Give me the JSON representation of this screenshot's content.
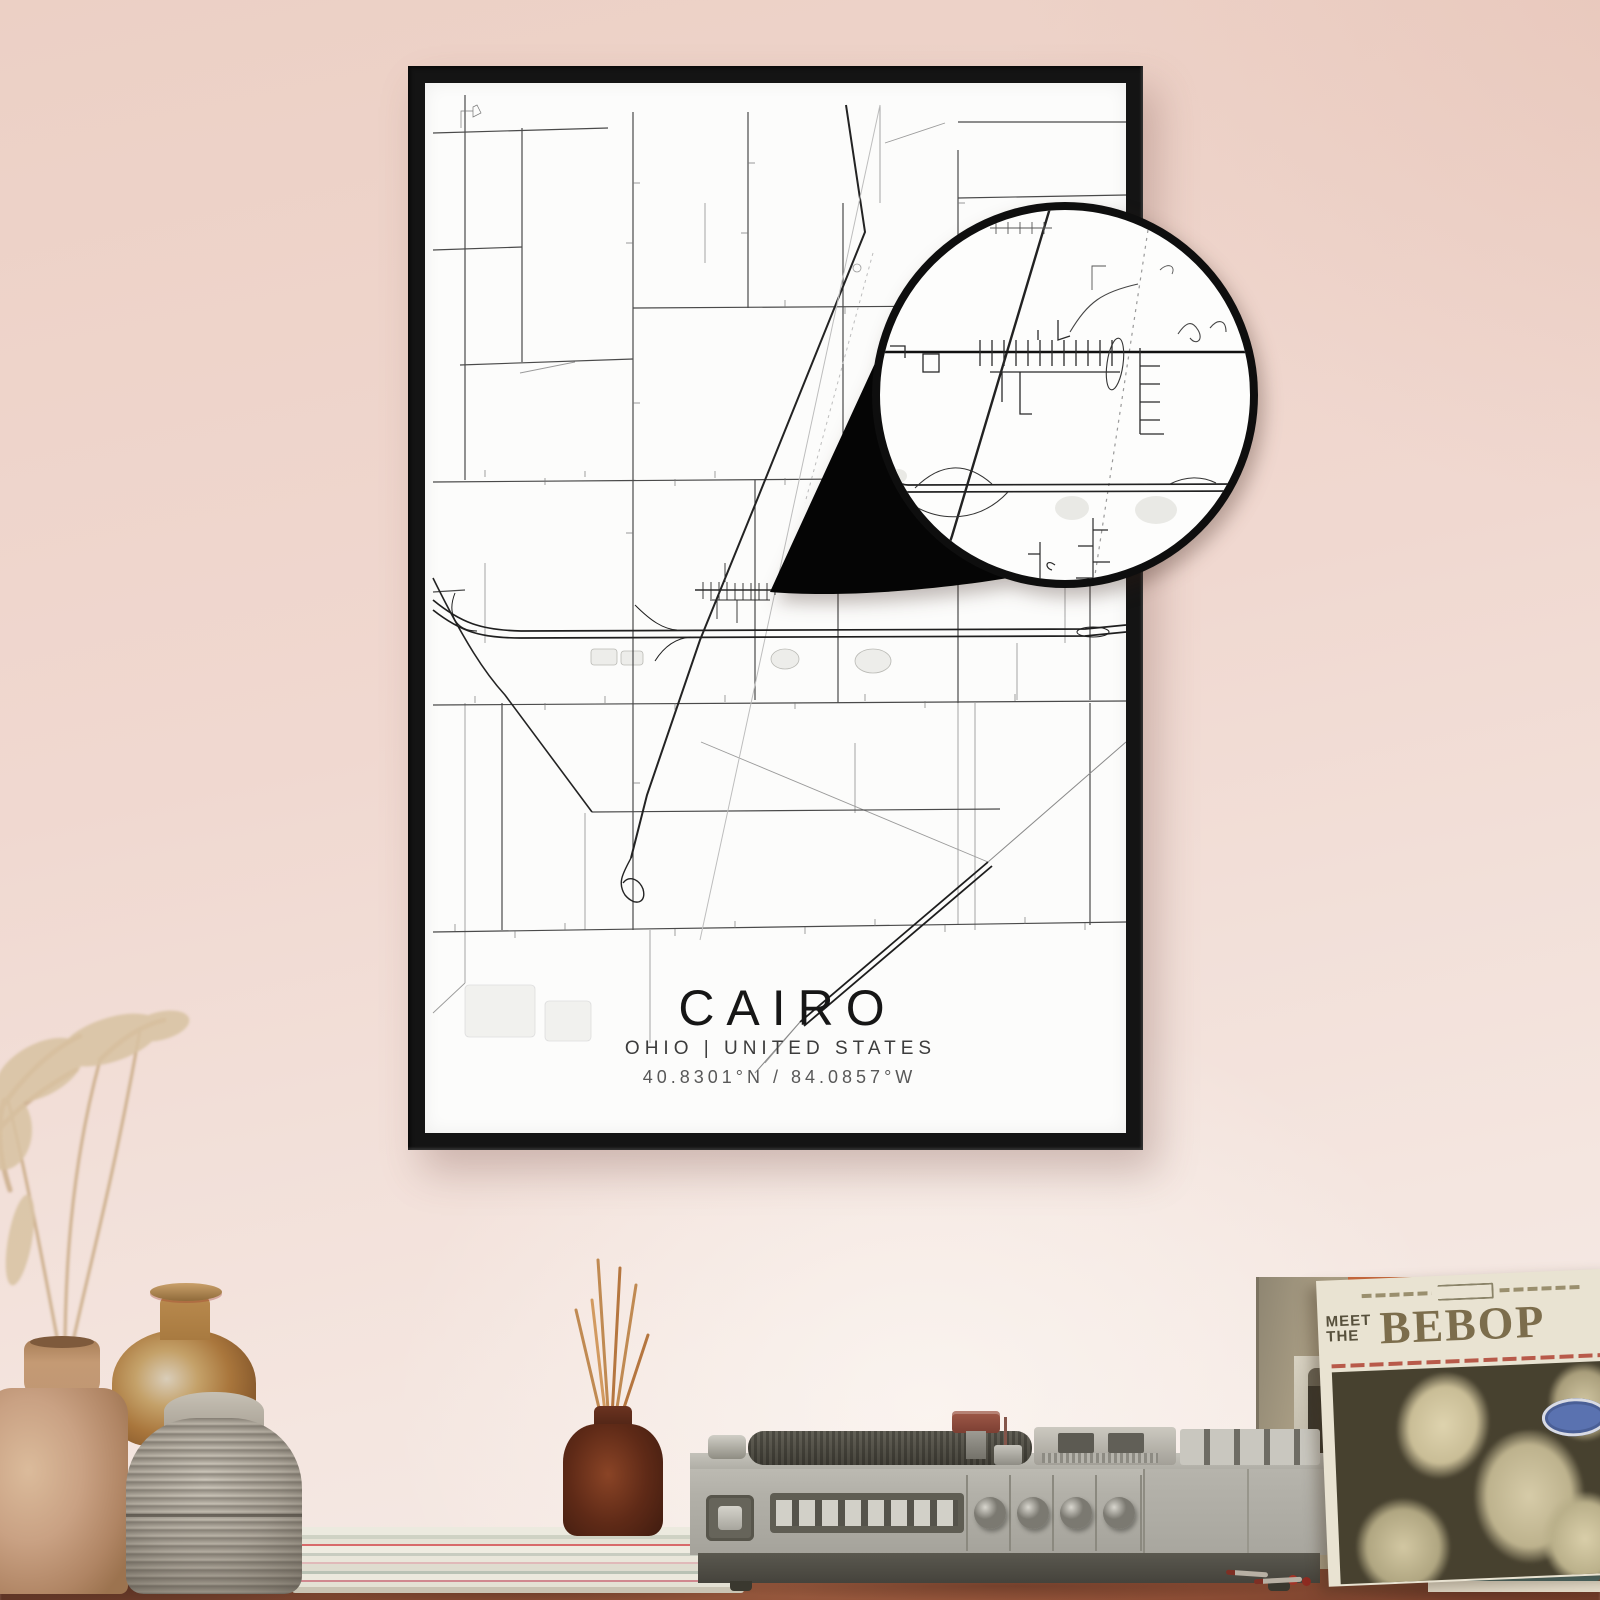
{
  "poster": {
    "title": "CAIRO",
    "subtitle": "OHIO | UNITED STATES",
    "coordinates": "40.8301°N / 84.0857°W",
    "paper_color": "#fcfcfb",
    "frame_color": "#141414",
    "road_color": "#3a3a3a"
  },
  "magnifier": {
    "rim_color": "#0e0e0e",
    "curl_color": "#050505"
  },
  "record_sleeve": {
    "header_line1": "MEET",
    "header_line2": "THE",
    "title": "BEBOP",
    "title_color": "#7c6d4c",
    "photo_bg": "#47412f",
    "logo_color": "#5a72b0"
  },
  "colors": {
    "wall_top": "#ecd0c5",
    "wall_bottom": "#f6ece8",
    "table": "#8a4c34",
    "player_body": "#b2b0a8",
    "player_base": "#45433c",
    "vase_tan": "#c9a183",
    "vase_amber": "#b9884e",
    "vase_gray": "#b0a99d",
    "bottle_brown": "#5f2a17",
    "pampas": "#cdb08e",
    "teal_record": "#4a6a68",
    "orange_strip": "#c96a3e"
  }
}
